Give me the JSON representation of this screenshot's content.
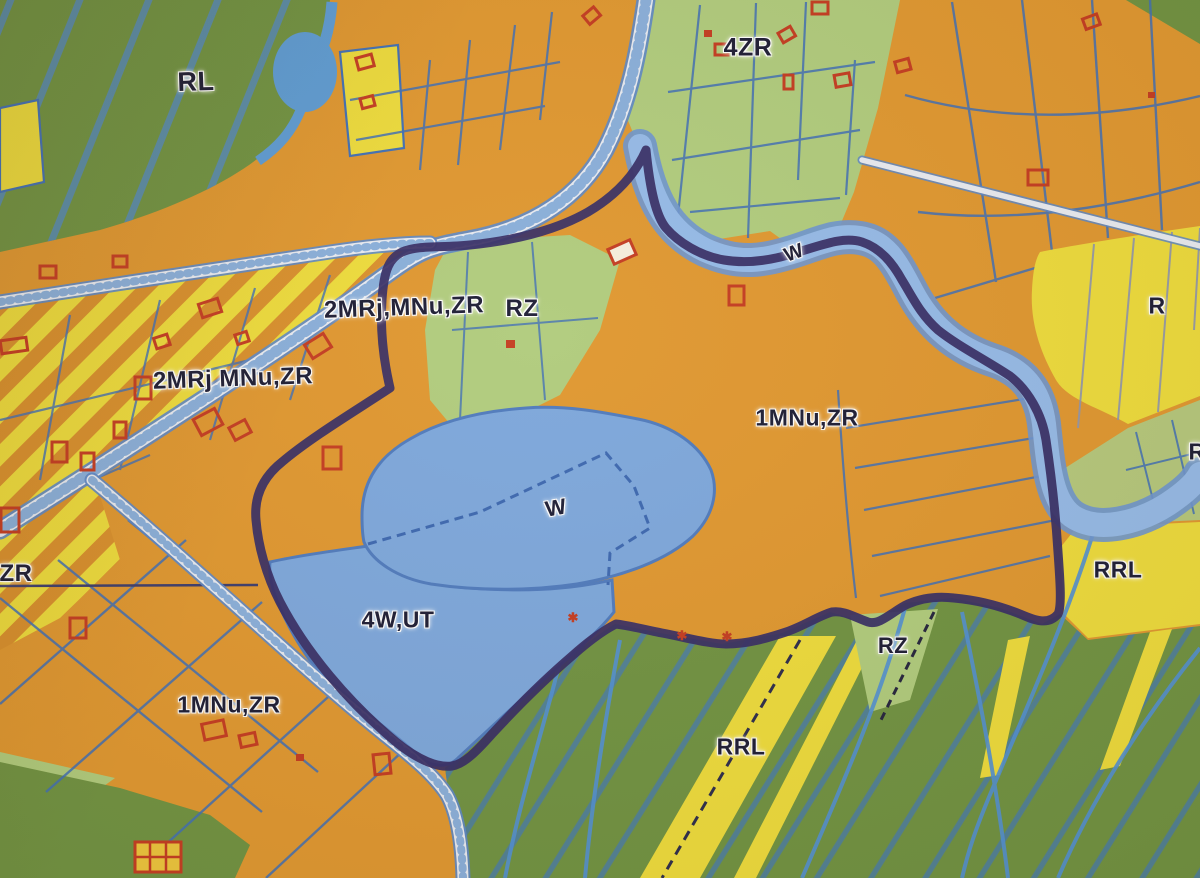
{
  "meta": {
    "description": "Photographed zoning / land-use plan map with colored destination zones, water areas, roads and a thick dark plan boundary",
    "map_type": "zoning-plan"
  },
  "palette": {
    "orange": "#DF962E",
    "orange_stripe": "#D88E2A",
    "dark_green": "#6E9140",
    "light_green": "#AFCB7C",
    "olive_green": "#B4C77B",
    "yellow": "#EDDB3A",
    "lake_blue": "#7BA6DC",
    "river_blue": "#93B9E8",
    "stream_blue": "#4F8FD3",
    "parcel_blue": "#3F6EB5",
    "boundary_navy": "#342A63",
    "road_fill": "#E8EBF2",
    "building_red": "#C33A1F",
    "label_text": "#1A1A33",
    "label_halo": "#FFFFFF"
  },
  "zone_codes": [
    "RL",
    "4ZR",
    "2MRj,MNu,ZR",
    "RZ",
    "2MRj MNu,ZR",
    "W",
    "1MNu,ZR",
    "R",
    "RRL",
    "ZR",
    "4W,UT"
  ],
  "labels": [
    {
      "id": "rl",
      "text": "RL",
      "x": 196,
      "y": 82,
      "rot": -2,
      "size": 27
    },
    {
      "id": "zr4",
      "text": "4ZR",
      "x": 748,
      "y": 48,
      "rot": 0,
      "size": 25
    },
    {
      "id": "mrj-upper",
      "text": "2MRj,MNu,ZR",
      "x": 404,
      "y": 308,
      "rot": -2,
      "size": 24
    },
    {
      "id": "rz-center",
      "text": "RZ",
      "x": 522,
      "y": 309,
      "rot": 0,
      "size": 24
    },
    {
      "id": "mrj-lower",
      "text": "2MRj MNu,ZR",
      "x": 233,
      "y": 379,
      "rot": -2,
      "size": 24
    },
    {
      "id": "w-river",
      "text": "W",
      "x": 794,
      "y": 253,
      "rot": -20,
      "size": 20
    },
    {
      "id": "mnu1-right",
      "text": "1MNu,ZR",
      "x": 807,
      "y": 418,
      "rot": 0,
      "size": 23
    },
    {
      "id": "r-strip",
      "text": "R",
      "x": 1157,
      "y": 306,
      "rot": 0,
      "size": 23
    },
    {
      "id": "r-edge",
      "text": "R",
      "x": 1197,
      "y": 452,
      "rot": 0,
      "size": 23
    },
    {
      "id": "w-lake",
      "text": "W",
      "x": 556,
      "y": 508,
      "rot": -10,
      "size": 22
    },
    {
      "id": "rrl-right",
      "text": "RRL",
      "x": 1118,
      "y": 570,
      "rot": 0,
      "size": 23
    },
    {
      "id": "rz-small",
      "text": "RZ",
      "x": 893,
      "y": 646,
      "rot": 0,
      "size": 22
    },
    {
      "id": "zr-left",
      "text": "ZR",
      "x": 16,
      "y": 574,
      "rot": 0,
      "size": 24
    },
    {
      "id": "wut4",
      "text": "4W,UT",
      "x": 398,
      "y": 620,
      "rot": 0,
      "size": 23
    },
    {
      "id": "mnu1-left",
      "text": "1MNu,ZR",
      "x": 229,
      "y": 705,
      "rot": 0,
      "size": 23
    },
    {
      "id": "rrl-bottom",
      "text": "RRL",
      "x": 741,
      "y": 747,
      "rot": 0,
      "size": 23
    }
  ],
  "markers": [
    {
      "type": "asterisk",
      "glyph": "✱",
      "x": 573,
      "y": 618
    },
    {
      "type": "asterisk",
      "glyph": "✱",
      "x": 682,
      "y": 636
    },
    {
      "type": "asterisk",
      "glyph": "✱",
      "x": 727,
      "y": 637
    }
  ]
}
